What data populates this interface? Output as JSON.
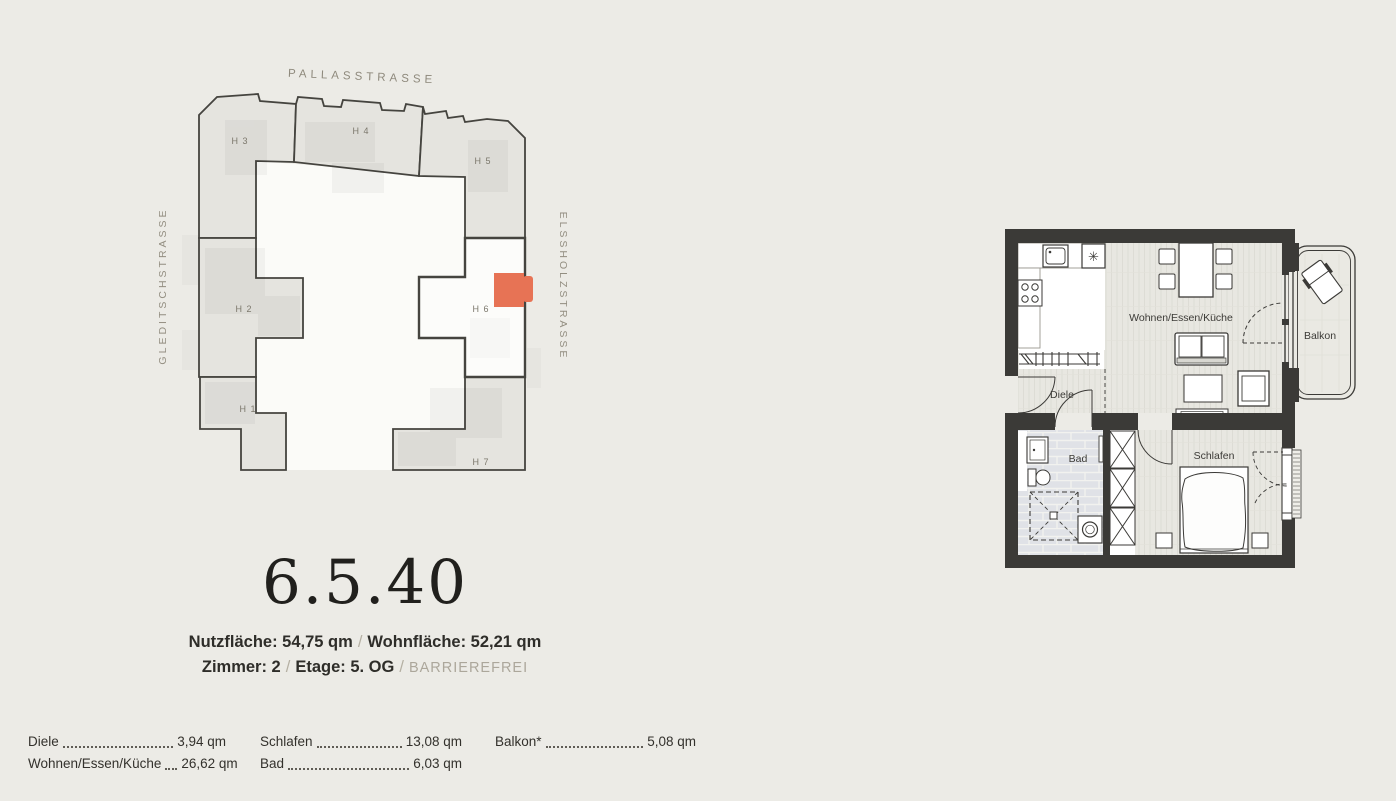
{
  "colors": {
    "background": "#ECEBE6",
    "building_fill": "#E5E4DF",
    "highlight_building_fill": "#FCFCFA",
    "accent_orange": "#E77355",
    "wall_dark": "#3B3A37",
    "street_text": "#8E897C",
    "muted_text": "#ACA79B",
    "primary_text": "#2E2D29"
  },
  "site_plan": {
    "street_top": "PALLASSTRASSE",
    "street_left": "GLEDITSCHSTRASSE",
    "street_right": "ELSSHOLZSTRASSE",
    "buildings": {
      "h3": "H 3",
      "h4": "H 4",
      "h5": "H 5",
      "h2": "H 2",
      "h6": "H 6",
      "h1": "H 1",
      "h7": "H 7"
    }
  },
  "unit": {
    "number": "6.5.40",
    "nutzflaeche": "Nutzfläche: 54,75 qm",
    "wohnflaeche": "Wohnfläche: 52,21 qm",
    "zimmer": "Zimmer: 2",
    "etage": "Etage: 5. OG",
    "barrierefrei": "BARRIEREFREI",
    "separator": "/"
  },
  "floor_plan": {
    "labels": {
      "living": "Wohnen/Essen/Küche",
      "balcony": "Balkon",
      "hall": "Diele",
      "bath": "Bad",
      "bedroom": "Schlafen"
    },
    "snowflake_symbol": "✳"
  },
  "room_table": {
    "columns": [
      {
        "rows": [
          {
            "label": "Diele",
            "value": "3,94 qm"
          },
          {
            "label": "Wohnen/Essen/Küche",
            "value": "26,62 qm"
          }
        ]
      },
      {
        "rows": [
          {
            "label": "Schlafen",
            "value": "13,08 qm"
          },
          {
            "label": "Bad",
            "value": "6,03 qm"
          }
        ]
      },
      {
        "rows": [
          {
            "label": "Balkon*",
            "value": "5,08 qm"
          }
        ]
      }
    ]
  }
}
